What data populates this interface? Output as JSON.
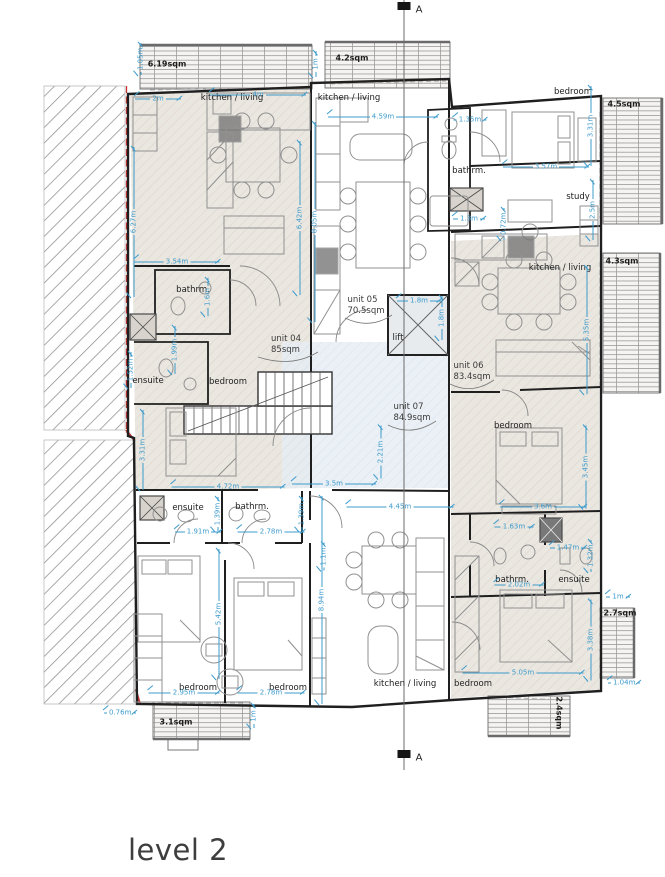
{
  "title": "level 2",
  "section": {
    "letter": "A",
    "markers": [
      {
        "x": 404,
        "y": 6
      },
      {
        "x": 404,
        "y": 754
      }
    ]
  },
  "colors": {
    "dimension_blue": "#3d9bcc",
    "wall": "#1f1f1f",
    "boundary_red": "#c83232",
    "unit_fill": "#eae6e0",
    "core_fill": "#e6edf3"
  },
  "units": [
    {
      "name": "unit 04",
      "area": "85sqm",
      "x": 286,
      "y": 345
    },
    {
      "name": "unit 05",
      "area": "70.5sqm",
      "x": 366,
      "y": 306
    },
    {
      "name": "unit 06",
      "area": "83.4sqm",
      "x": 472,
      "y": 372
    },
    {
      "name": "unit 07",
      "area": "84.9sqm",
      "x": 412,
      "y": 413
    }
  ],
  "rooms": [
    {
      "label": "kitchen / living",
      "x": 232,
      "y": 98
    },
    {
      "label": "kitchen / living",
      "x": 349,
      "y": 98
    },
    {
      "label": "bedroom",
      "x": 573,
      "y": 92
    },
    {
      "label": "bathrm.",
      "x": 469,
      "y": 171
    },
    {
      "label": "study",
      "x": 578,
      "y": 197
    },
    {
      "label": "kitchen / living",
      "x": 560,
      "y": 268
    },
    {
      "label": "bathrm.",
      "x": 193,
      "y": 290
    },
    {
      "label": "lift",
      "x": 398,
      "y": 338
    },
    {
      "label": "ensuite",
      "x": 148,
      "y": 381
    },
    {
      "label": "bedroom",
      "x": 228,
      "y": 382
    },
    {
      "label": "ensuite",
      "x": 188,
      "y": 508
    },
    {
      "label": "bathrm.",
      "x": 252,
      "y": 507
    },
    {
      "label": "bedroom",
      "x": 513,
      "y": 426
    },
    {
      "label": "bathrm.",
      "x": 512,
      "y": 580
    },
    {
      "label": "ensuite",
      "x": 574,
      "y": 580
    },
    {
      "label": "bedroom",
      "x": 198,
      "y": 688
    },
    {
      "label": "bedroom",
      "x": 288,
      "y": 688
    },
    {
      "label": "kitchen / living",
      "x": 405,
      "y": 684
    },
    {
      "label": "bedroom",
      "x": 473,
      "y": 684
    }
  ],
  "balconies": [
    {
      "area": "6.19sqm",
      "x": 167,
      "y": 64
    },
    {
      "area": "4.2sqm",
      "x": 352,
      "y": 58
    },
    {
      "area": "4.5sqm",
      "x": 624,
      "y": 104
    },
    {
      "area": "4.3sqm",
      "x": 622,
      "y": 261
    },
    {
      "area": "2.7sqm",
      "x": 620,
      "y": 613
    },
    {
      "area": "2.4sqm",
      "x": 559,
      "y": 713,
      "v": true
    },
    {
      "area": "3.1sqm",
      "x": 176,
      "y": 722
    }
  ],
  "dimensions": [
    {
      "t": "1.05m",
      "x": 141,
      "y": 62,
      "o": "v",
      "l": 26
    },
    {
      "t": "2m",
      "x": 158,
      "y": 99,
      "o": "h",
      "l": 46
    },
    {
      "t": "4m",
      "x": 258,
      "y": 95,
      "o": "h",
      "l": 96
    },
    {
      "t": "1m",
      "x": 316,
      "y": 64,
      "o": "v",
      "l": 26
    },
    {
      "t": "4.59m",
      "x": 383,
      "y": 117,
      "o": "h",
      "l": 110
    },
    {
      "t": "6.27m",
      "x": 134,
      "y": 222,
      "o": "v",
      "l": 150
    },
    {
      "t": "8.05m",
      "x": 315,
      "y": 222,
      "o": "v",
      "l": 200
    },
    {
      "t": "6.42m",
      "x": 300,
      "y": 218,
      "o": "v",
      "l": 154
    },
    {
      "t": "3.54m",
      "x": 177,
      "y": 262,
      "o": "h",
      "l": 85
    },
    {
      "t": "1.35m",
      "x": 470,
      "y": 120,
      "o": "h",
      "l": 33
    },
    {
      "t": "3.31m",
      "x": 591,
      "y": 126,
      "o": "v",
      "l": 80
    },
    {
      "t": "3.57m",
      "x": 546,
      "y": 167,
      "o": "h",
      "l": 86
    },
    {
      "t": "1.3m",
      "x": 469,
      "y": 219,
      "o": "h",
      "l": 32
    },
    {
      "t": "0.72m",
      "x": 504,
      "y": 229,
      "o": "v",
      "l": 22
    },
    {
      "t": "2.5m",
      "x": 593,
      "y": 210,
      "o": "v",
      "l": 60
    },
    {
      "t": "1.8m",
      "x": 419,
      "y": 301,
      "o": "h",
      "l": 44
    },
    {
      "t": "1.8m",
      "x": 442,
      "y": 318,
      "o": "v",
      "l": 44
    },
    {
      "t": "5.35m",
      "x": 587,
      "y": 330,
      "o": "v",
      "l": 128
    },
    {
      "t": "1.6m",
      "x": 208,
      "y": 297,
      "o": "v",
      "l": 38
    },
    {
      "t": "1.52m",
      "x": 131,
      "y": 370,
      "o": "v",
      "l": 36
    },
    {
      "t": "1.99m",
      "x": 175,
      "y": 350,
      "o": "v",
      "l": 48
    },
    {
      "t": "3.31m",
      "x": 143,
      "y": 450,
      "o": "v",
      "l": 80
    },
    {
      "t": "4.72m",
      "x": 228,
      "y": 487,
      "o": "h",
      "l": 113
    },
    {
      "t": "3.5m",
      "x": 334,
      "y": 484,
      "o": "h",
      "l": 84
    },
    {
      "t": "2.21m",
      "x": 381,
      "y": 452,
      "o": "v",
      "l": 53
    },
    {
      "t": "4.45m",
      "x": 400,
      "y": 507,
      "o": "h",
      "l": 107
    },
    {
      "t": "1.91m",
      "x": 198,
      "y": 532,
      "o": "h",
      "l": 46
    },
    {
      "t": "2.78m",
      "x": 271,
      "y": 532,
      "o": "h",
      "l": 67
    },
    {
      "t": "1.39m",
      "x": 218,
      "y": 514,
      "o": "v",
      "l": 34
    },
    {
      "t": "1.39m",
      "x": 302,
      "y": 514,
      "o": "v",
      "l": 34
    },
    {
      "t": "1.1m",
      "x": 324,
      "y": 557,
      "o": "v",
      "l": 27
    },
    {
      "t": "2.95m",
      "x": 184,
      "y": 693,
      "o": "h",
      "l": 71
    },
    {
      "t": "2.78m",
      "x": 271,
      "y": 693,
      "o": "h",
      "l": 67
    },
    {
      "t": "5.42m",
      "x": 219,
      "y": 614,
      "o": "v",
      "l": 130
    },
    {
      "t": "8.94m",
      "x": 322,
      "y": 600,
      "o": "v",
      "l": 208
    },
    {
      "t": "1m",
      "x": 254,
      "y": 716,
      "o": "v",
      "l": 24
    },
    {
      "t": "0.76m",
      "x": 114,
      "y": 713,
      "o": "h",
      "l": 20
    },
    {
      "t": "3.6m",
      "x": 543,
      "y": 507,
      "o": "h",
      "l": 86
    },
    {
      "t": "3.45m",
      "x": 586,
      "y": 467,
      "o": "v",
      "l": 83
    },
    {
      "t": "1.63m",
      "x": 514,
      "y": 527,
      "o": "h",
      "l": 39
    },
    {
      "t": "1.47m",
      "x": 568,
      "y": 548,
      "o": "h",
      "l": 36
    },
    {
      "t": "1.32m",
      "x": 591,
      "y": 556,
      "o": "v",
      "l": 32
    },
    {
      "t": "2.02m",
      "x": 519,
      "y": 585,
      "o": "h",
      "l": 49
    },
    {
      "t": "3.38m",
      "x": 591,
      "y": 640,
      "o": "v",
      "l": 81
    },
    {
      "t": "5.05m",
      "x": 523,
      "y": 673,
      "o": "h",
      "l": 121
    },
    {
      "t": "1m",
      "x": 618,
      "y": 597,
      "o": "h",
      "l": 24
    },
    {
      "t": "1.04m",
      "x": 621,
      "y": 683,
      "o": "h",
      "l": 26
    }
  ]
}
